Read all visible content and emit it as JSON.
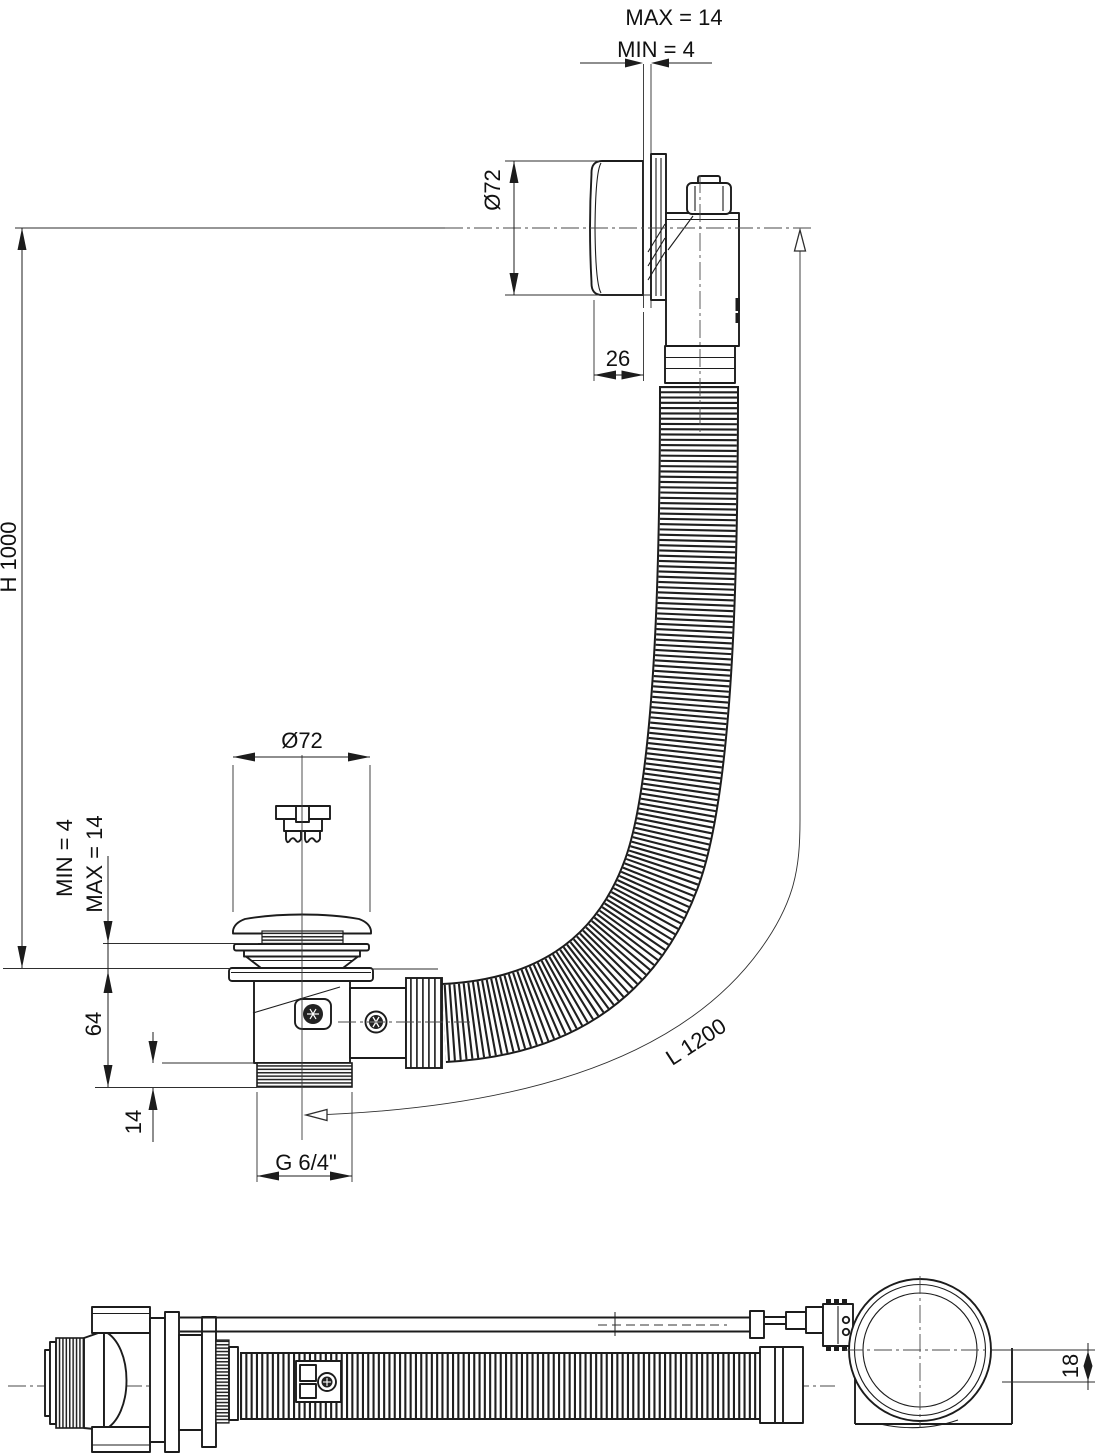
{
  "meta": {
    "background": "#ffffff",
    "line_color": "#1c1c1c",
    "centerline_color": "#4a4a4a"
  },
  "labels": {
    "wall_thickness_max": "MAX = 14",
    "wall_thickness_min": "MIN =  4",
    "overflow_cap_diameter": "Ø72",
    "overflow_cap_depth": "26",
    "installation_height": "H 1000",
    "waste_cap_diameter": "Ø72",
    "floor_thickness_min": "MIN = 4",
    "floor_thickness_max": "MAX = 14",
    "waste_body_height": "64",
    "thread_length": "14",
    "thread_size": "G 6/4\"",
    "hose_length": "L 1200",
    "overflow_axis_offset": "18"
  }
}
